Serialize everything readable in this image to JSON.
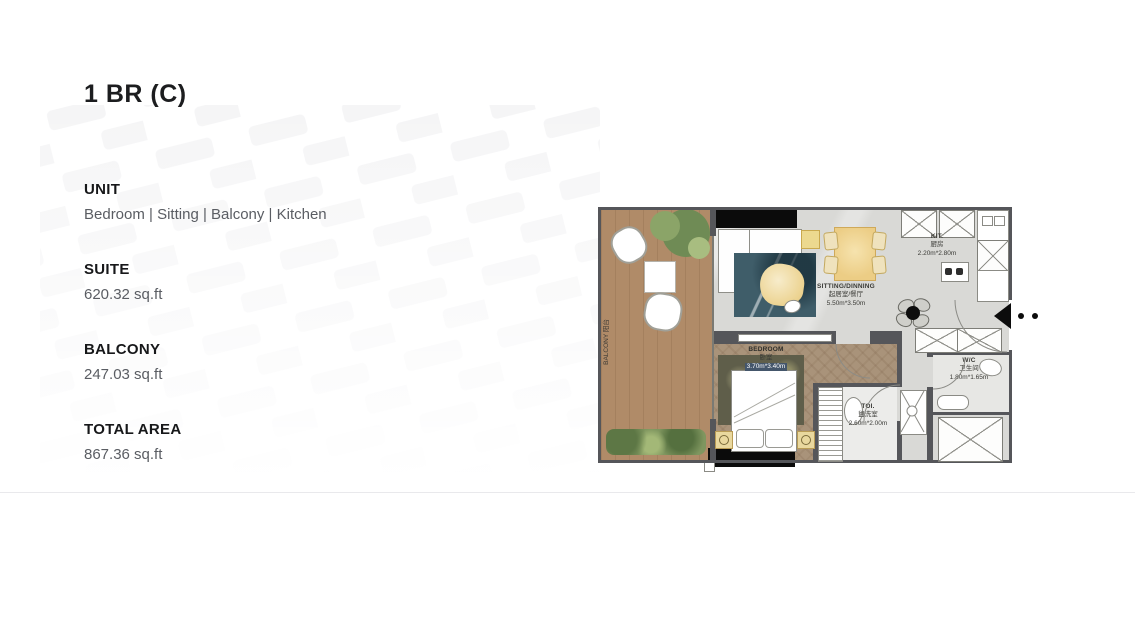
{
  "page": {
    "title": "1 BR (C)"
  },
  "specs": [
    {
      "label": "UNIT",
      "value": "Bedroom | Sitting | Balcony | Kitchen"
    },
    {
      "label": "SUITE",
      "value": "620.32 sq.ft"
    },
    {
      "label": "BALCONY",
      "value": "247.03 sq.ft"
    },
    {
      "label": "TOTAL AREA",
      "value": "867.36 sq.ft"
    }
  ],
  "floorplan": {
    "balcony": {
      "en": "BALCONY",
      "zh": "阳台"
    },
    "sitting": {
      "en": "SITTING/DINNING",
      "zh": "起居室/餐厅",
      "dims": "5.50m*3.50m"
    },
    "kitchen": {
      "en": "KIT.",
      "zh": "厨房",
      "dims": "2.20m*2.80m"
    },
    "bedroom": {
      "en": "BEDROOM",
      "zh": "卧室",
      "dims": "3.70m*3.40m"
    },
    "toilet": {
      "en": "TOI.",
      "zh": "盥洗室",
      "dims": "2.60m*2.00m"
    },
    "wc": {
      "en": "W/C",
      "zh": "卫生间",
      "dims": "1.80m*1.65m"
    }
  },
  "colors": {
    "wall": "#55565a",
    "shear_wall": "#0b0b0b",
    "balcony_wood": "#b08b68",
    "bedroom_wood": "#a9937a",
    "floor_gray": "#d9d9d6",
    "rug_teal": "#3f5d69",
    "table_yellow": "#eccd85",
    "text_dark": "#1c1d1f",
    "text_gray": "#5a5d63"
  }
}
